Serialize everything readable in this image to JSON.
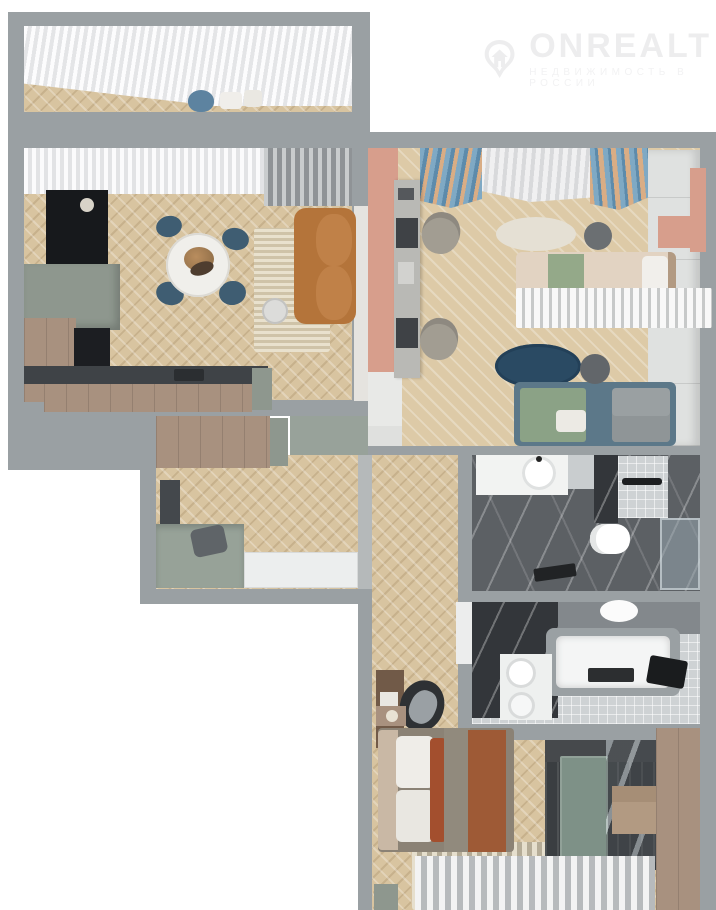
{
  "watermark": {
    "brand": "ONREALT",
    "tagline": "НЕДВИЖИМОСТЬ В РОССИИ"
  },
  "palette": {
    "wall_grey": "#9aa0a3",
    "floor_wood": "#d8c4a0",
    "accent_sage": "#8e978e",
    "accent_pink": "#d79e8c",
    "chair_navy": "#3f5d72",
    "rug_navy": "#2a4a63",
    "sofa_caramel": "#b4743a",
    "marble_grey": "#5c6064",
    "bed_terracotta": "#9e5a36",
    "watermark_grey": "#ededee"
  }
}
